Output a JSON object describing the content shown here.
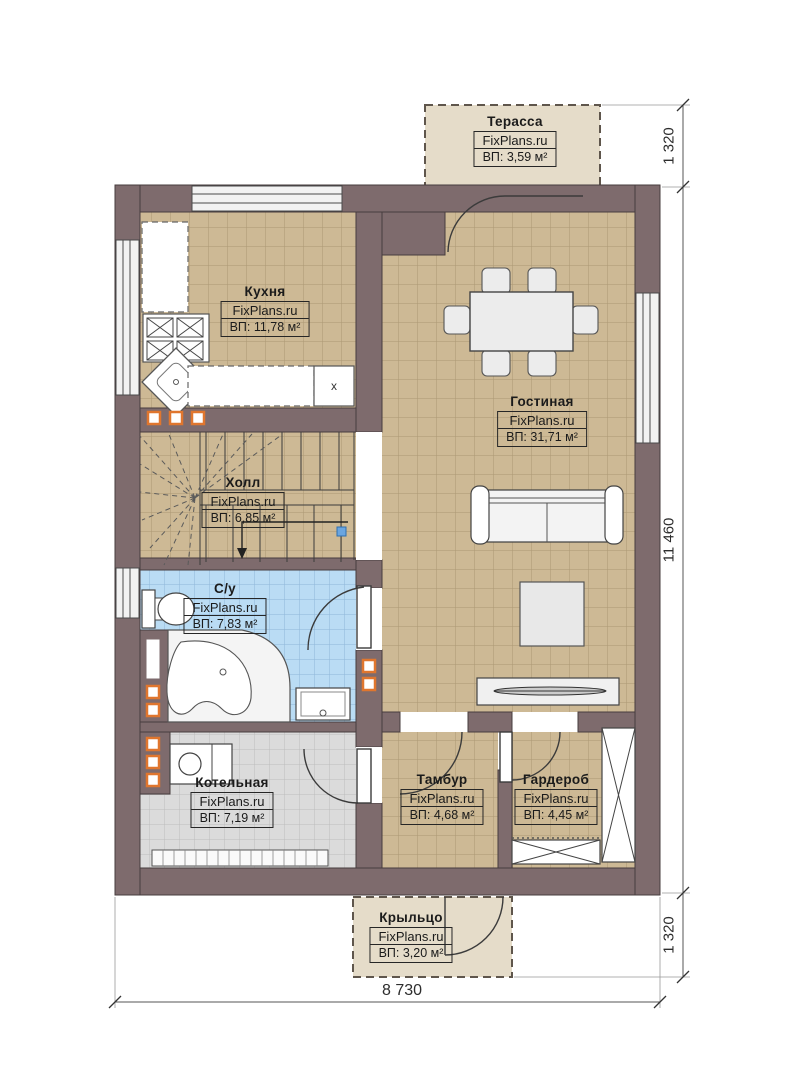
{
  "plan": {
    "rooms": {
      "terrace": {
        "name": "Терасса",
        "brand": "FixPlans.ru",
        "area": "ВП: 3,59 м²"
      },
      "kitchen": {
        "name": "Кухня",
        "brand": "FixPlans.ru",
        "area": "ВП: 11,78 м²",
        "appliance_label": "x"
      },
      "living_room": {
        "name": "Гостиная",
        "brand": "FixPlans.ru",
        "area": "ВП: 31,71 м²"
      },
      "hall": {
        "name": "Холл",
        "brand": "FixPlans.ru",
        "area": "ВП: 6,85 м²"
      },
      "bathroom": {
        "name": "С/у",
        "brand": "FixPlans.ru",
        "area": "ВП: 7,83 м²"
      },
      "boiler_room": {
        "name": "Котельная",
        "brand": "FixPlans.ru",
        "area": "ВП: 7,19 м²"
      },
      "vestibule": {
        "name": "Тамбур",
        "brand": "FixPlans.ru",
        "area": "ВП: 4,68 м²"
      },
      "wardrobe": {
        "name": "Гардероб",
        "brand": "FixPlans.ru",
        "area": "ВП: 4,45 м²"
      },
      "porch": {
        "name": "Крыльцо",
        "brand": "FixPlans.ru",
        "area": "ВП: 3,20 м²"
      }
    },
    "dimensions": {
      "right_top": "1 320",
      "right_middle": "11 460",
      "right_bottom": "1 320",
      "bottom_width": "8 730"
    },
    "colors": {
      "wall": "#7e6b6d",
      "floor_tan": "#cdb995",
      "floor_blue": "#badcf4",
      "floor_gray": "#dbdbdb",
      "outdoor": "#e5dcc9",
      "vent_accent": "#e0762e"
    }
  }
}
